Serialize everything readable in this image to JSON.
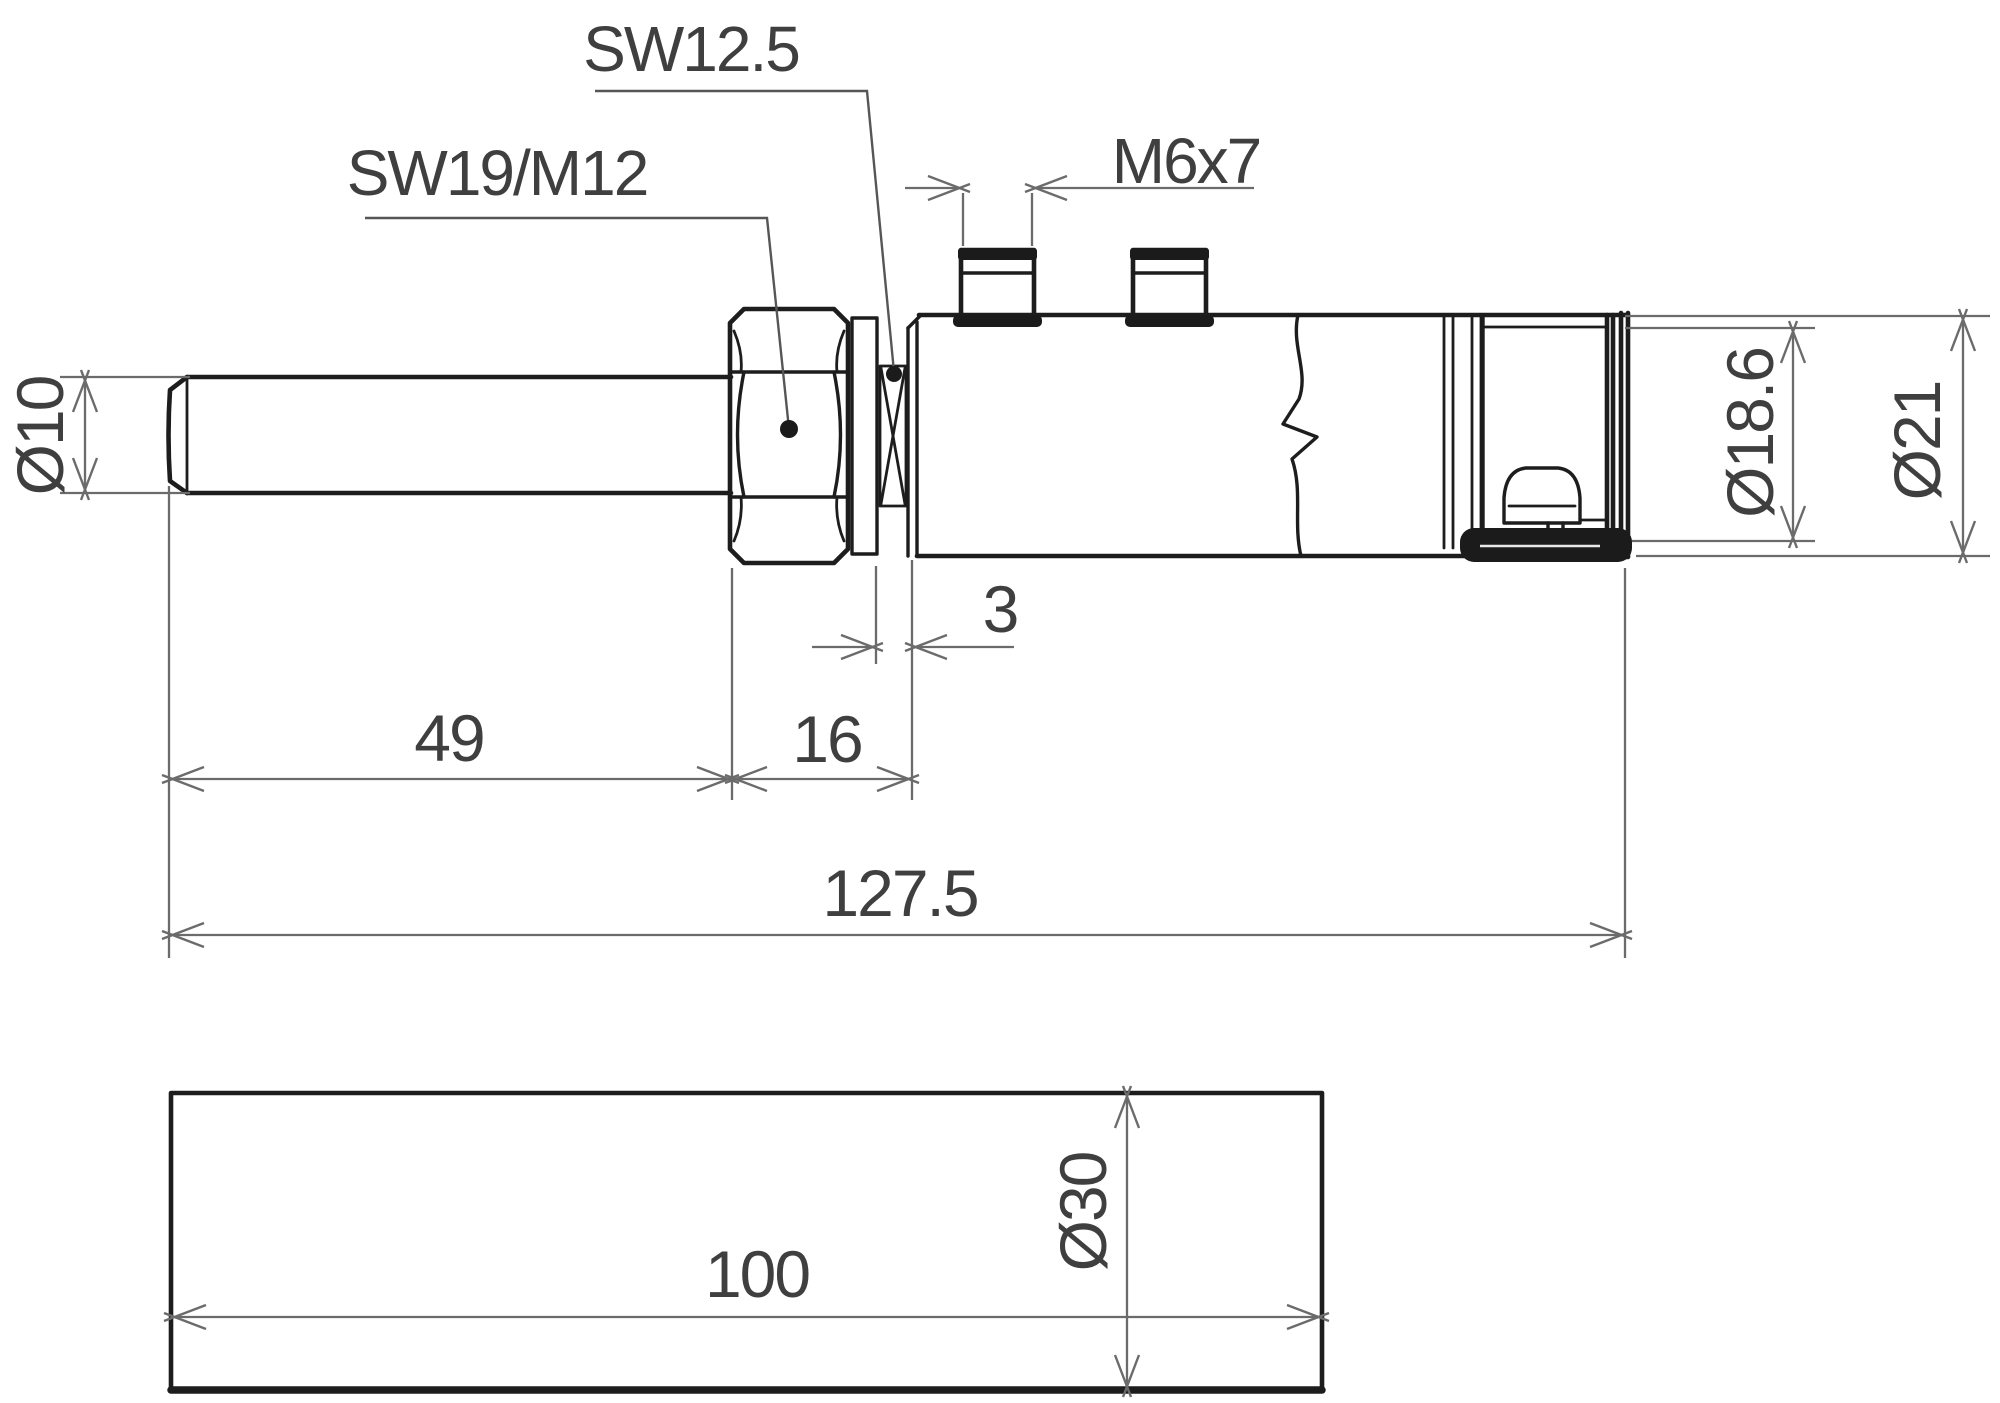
{
  "side_view": {
    "callout_sw125": "SW12.5",
    "callout_sw19_m12": "SW19/M12",
    "callout_m6x7": "M6x7",
    "dim_probe_diameter": "Ø10",
    "dim_probe_length": "49",
    "dim_hex_length": "16",
    "dim_thread_gap": "3",
    "dim_overall_length": "127.5",
    "dim_housing_diameter": "Ø18.6",
    "dim_connector_diameter": "Ø21"
  },
  "protection_tube_view": {
    "dim_length": "100",
    "dim_diameter": "Ø30"
  },
  "colors": {
    "part_line": "#1d1d1d",
    "dimension_line": "#6b6b6b",
    "text": "#3f3f3f",
    "background": "#ffffff"
  }
}
